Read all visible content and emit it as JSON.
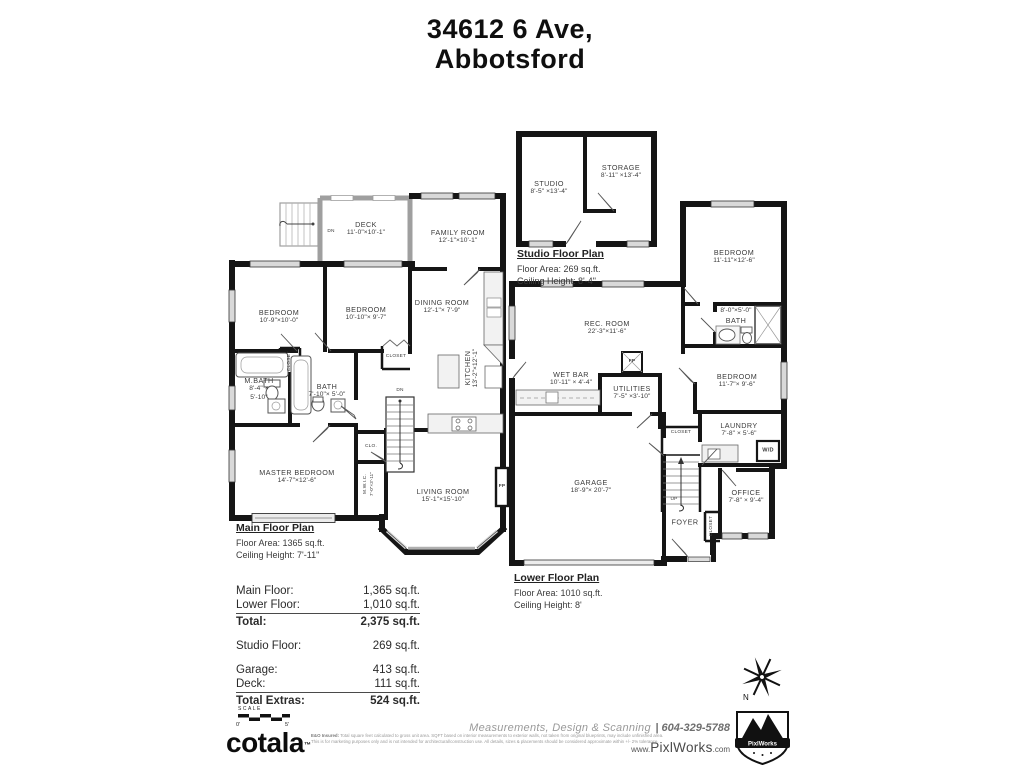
{
  "title": {
    "line1": "34612 6 Ave,",
    "line2": "Abbotsford"
  },
  "plans": {
    "main": {
      "label": "Main Floor Plan",
      "area": "Floor Area: 1365 sq.ft.",
      "ceiling": "Ceiling Height: 7'-11\"",
      "rooms": {
        "deck": {
          "name": "DECK",
          "dims": "11'-0\"×10'-1\""
        },
        "family": {
          "name": "FAMILY ROOM",
          "dims": "12'-1\"×10'-1\""
        },
        "bed1": {
          "name": "BEDROOM",
          "dims": "10'-9\"×10'-0\""
        },
        "bed2": {
          "name": "BEDROOM",
          "dims": "10'-10\"× 9'-7\""
        },
        "dining": {
          "name": "DINING ROOM",
          "dims": "12'-1\"× 7'-9\""
        },
        "kitchen": {
          "name": "KITCHEN",
          "dims": "13'-2\"×12'-1\""
        },
        "mbath": {
          "name": "M.BATH",
          "dims": "8'-4\" × 5'-10\""
        },
        "bath": {
          "name": "BATH",
          "dims": "7'-10\"× 5'-0\""
        },
        "master": {
          "name": "MASTER BEDROOM",
          "dims": "14'-7\"×12'-6\""
        },
        "mwic": {
          "name": "M.W.I.C.",
          "dims": "7'-0\"×3'-11\""
        },
        "clo": {
          "name": "CLO."
        },
        "living": {
          "name": "LIVING ROOM",
          "dims": "15'-1\"×15'-10\""
        },
        "closet_a": {
          "name": "CLOSET"
        },
        "closet_b": {
          "name": "CLOSET"
        },
        "fp": {
          "name": "FP"
        },
        "dn_deck": {
          "name": "DN"
        },
        "dn_stair": {
          "name": "DN"
        }
      }
    },
    "studio": {
      "label": "Studio Floor Plan",
      "area": "Floor Area: 269 sq.ft.",
      "ceiling": "Ceiling Height: 8'-4\"",
      "rooms": {
        "studio": {
          "name": "STUDIO",
          "dims": "8'-5\" ×13'-4\""
        },
        "storage": {
          "name": "STORAGE",
          "dims": "8'-11\" ×13'-4\""
        }
      }
    },
    "lower": {
      "label": "Lower Floor Plan",
      "area": "Floor Area: 1010 sq.ft.",
      "ceiling": "Ceiling Height: 8'",
      "rooms": {
        "bed1": {
          "name": "BEDROOM",
          "dims": "11'-11\"×12'-6\""
        },
        "bath": {
          "name": "BATH",
          "dims": "8'-0\"×5'-0\""
        },
        "rec": {
          "name": "REC. ROOM",
          "dims": "22'-3\"×11'-6\""
        },
        "wetbar": {
          "name": "WET BAR",
          "dims": "10'-11\" × 4'-4\""
        },
        "utilities": {
          "name": "UTILITIES",
          "dims": "7'-5\" ×3'-10\""
        },
        "bed2": {
          "name": "BEDROOM",
          "dims": "11'-7\"× 9'-6\""
        },
        "laundry": {
          "name": "LAUNDRY",
          "dims": "7'-8\" × 5'-6\""
        },
        "wd": {
          "name": "W/D"
        },
        "garage": {
          "name": "GARAGE",
          "dims": "18'-9\"× 20'-7\""
        },
        "foyer": {
          "name": "FOYER"
        },
        "office": {
          "name": "OFFICE",
          "dims": "7'-8\" × 9'-4\""
        },
        "closet_a": {
          "name": "CLOSET"
        },
        "closet_b": {
          "name": "CLOSET"
        },
        "fp": {
          "name": "FP"
        },
        "up": {
          "name": "UP"
        }
      }
    }
  },
  "summary": {
    "rows": [
      {
        "label": "Main Floor:",
        "value": "1,365 sq.ft."
      },
      {
        "label": "Lower Floor:",
        "value": "1,010 sq.ft."
      },
      {
        "label": "Total:",
        "value": "2,375 sq.ft."
      },
      {
        "label": "Studio Floor:",
        "value": "269 sq.ft."
      },
      {
        "label": "Garage:",
        "value": "413 sq.ft."
      },
      {
        "label": "Deck:",
        "value": "111 sq.ft."
      },
      {
        "label": "Total Extras:",
        "value": "524 sq.ft."
      }
    ]
  },
  "footer": {
    "scale": {
      "label": "SCALE",
      "zero": "0'",
      "five": "5'"
    },
    "brand": "cotala",
    "brand_tm": "™",
    "disclaimer": {
      "lead": "E&O Insured:",
      "line1": "Total square feet calculated to gross unit area. SQFT based on interior measurements to exterior walls, not taken from original blueprints, may include unfinished area.",
      "line2": "This is for marketing purposes only and is not intended for architectural/construction use.  All details, sizes & placements should be considered approximate within +/- 2% tolerance."
    },
    "tagline": "Measurements, Design & Scanning",
    "phone": "| 604-329-5788",
    "website": {
      "www": "www.",
      "name": "PixlWorks",
      "com": ".com"
    },
    "compass_n": "N",
    "logo_text": "PixlWorks"
  },
  "colors": {
    "wall": "#151515",
    "deck_wall": "#9f9f9f",
    "window": "#d9d9d9"
  }
}
